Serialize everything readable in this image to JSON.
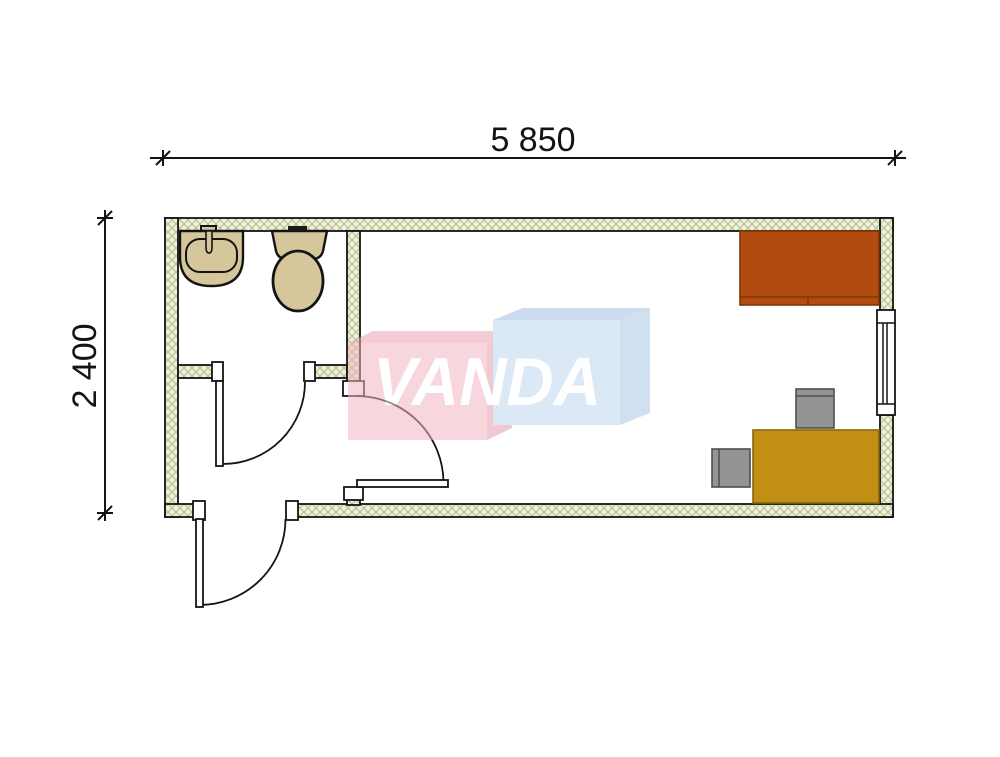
{
  "drawing": {
    "type": "architectural-floor-plan",
    "dimensions": {
      "width_label": "5 850",
      "height_label": "2 400"
    },
    "watermark": {
      "text": "VANDA"
    },
    "rooms": {
      "bathroom": {
        "fixtures": [
          "sink",
          "toilet"
        ]
      },
      "hallway": {
        "doors": [
          "bathroom-door",
          "interior-door",
          "entrance-door"
        ]
      },
      "office": {
        "furniture": [
          "bed",
          "desk",
          "chair",
          "chair"
        ],
        "openings": [
          "window"
        ]
      }
    },
    "colors": {
      "wall_fill": "#f0f0dc",
      "wall_hatch_line": "#b6bd8c",
      "line": "#141414",
      "fixture_fill": "#d6c69c",
      "fixture_edge": "#141414",
      "bed_fill": "#b24b10",
      "bed_edge": "#7d3708",
      "desk_fill": "#c18f16",
      "desk_edge": "#8a660f",
      "chair_fill": "#949494",
      "chair_edge": "#4f4f4f",
      "watermark_pink_front": "#f4b6c2",
      "watermark_pink_top": "#eba4b2",
      "watermark_pink_side": "#e69dab",
      "watermark_blue_front": "#bed6ee",
      "watermark_blue_top": "#9fc0e0",
      "watermark_blue_side": "#a9c7e4",
      "watermark_text_color": "#ffffff"
    }
  }
}
